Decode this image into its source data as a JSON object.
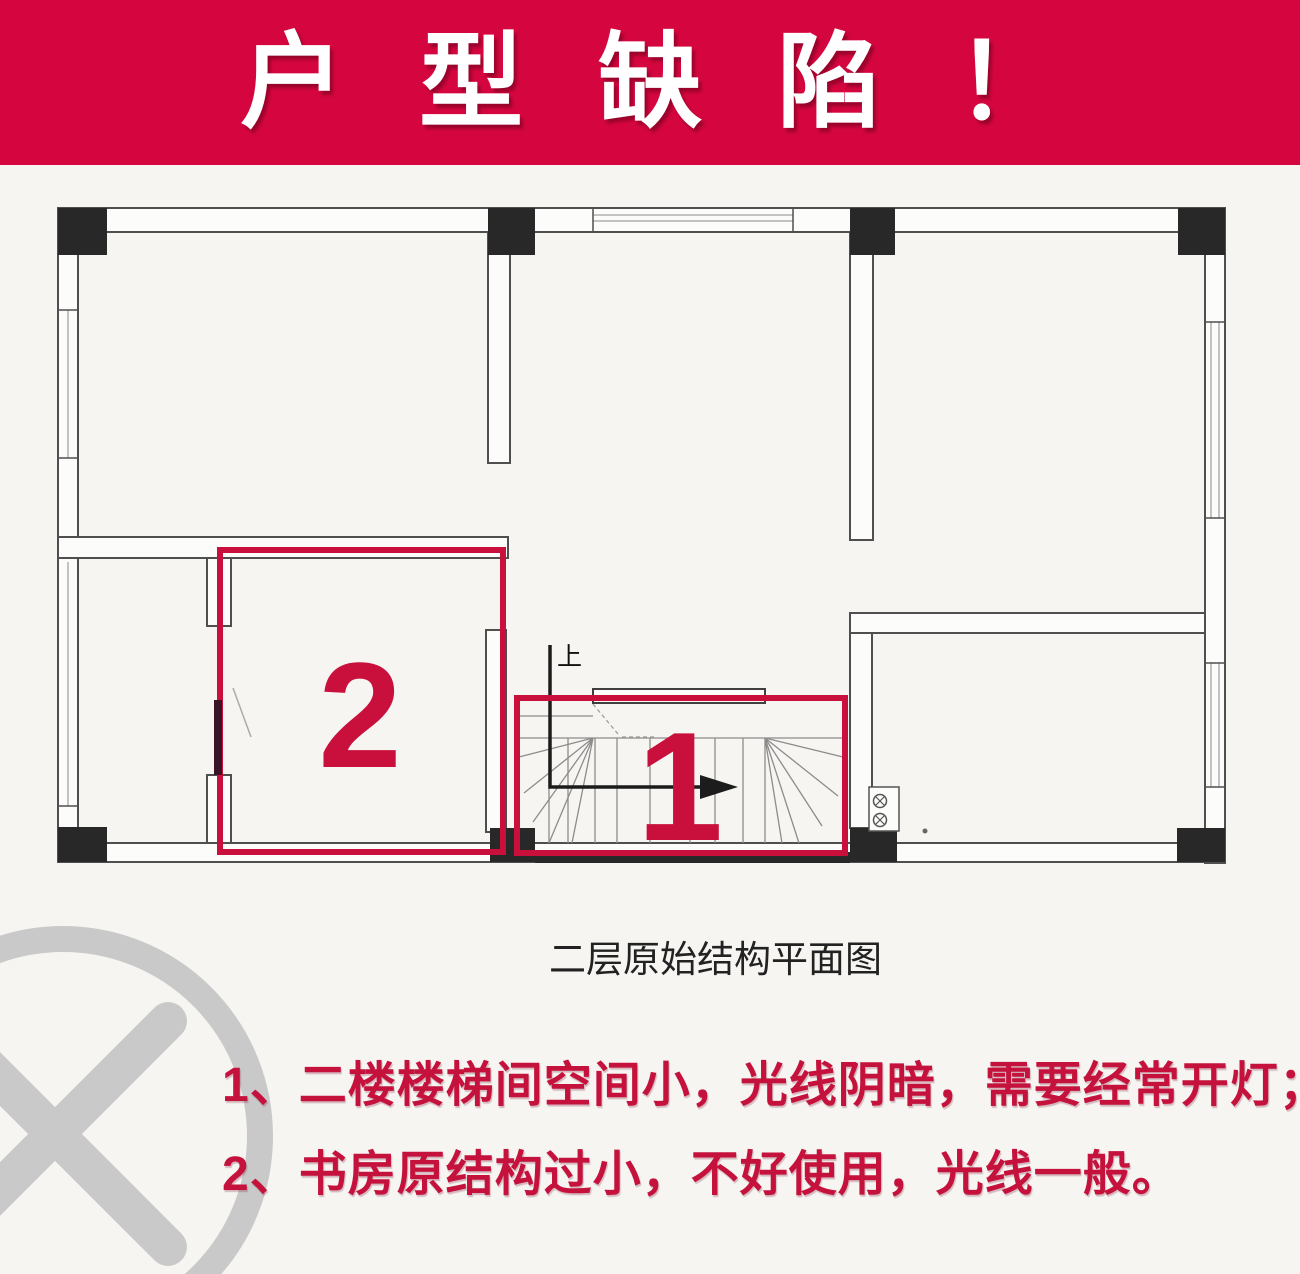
{
  "banner": {
    "title": "户型缺陷！"
  },
  "plan": {
    "caption": "二层原始结构平面图",
    "up_label": "上",
    "highlights": [
      {
        "number": "2",
        "meaning": "书房原结构过小"
      },
      {
        "number": "1",
        "meaning": "二楼楼梯间空间小"
      }
    ]
  },
  "issues": [
    {
      "line": "1、二楼楼梯间空间小，光线阴暗，需要经常开灯；"
    },
    {
      "line": "2、书房原结构过小，不好使用，光线一般。"
    }
  ],
  "colors": {
    "banner_red": "#d5063f",
    "highlight_red": "#c9103d",
    "text_red": "#c4123d",
    "wall_gray": "#4f4f4f",
    "column_black": "#282828",
    "watermark_gray": "#c9c9c9"
  }
}
